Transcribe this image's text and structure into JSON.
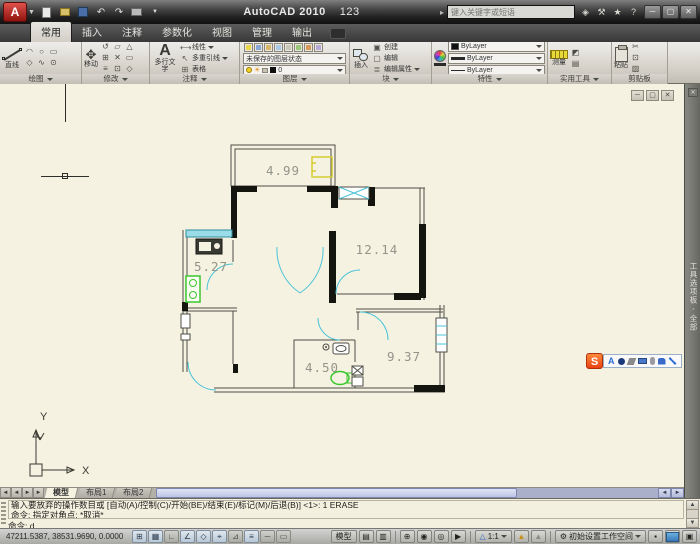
{
  "titlebar": {
    "app_title": "AutoCAD 2010",
    "doc_title": "123",
    "search_placeholder": "键入关键字或短语"
  },
  "ribbon": {
    "tabs": [
      {
        "label": "常用",
        "active": true
      },
      {
        "label": "插入",
        "active": false
      },
      {
        "label": "注释",
        "active": false
      },
      {
        "label": "参数化",
        "active": false
      },
      {
        "label": "视图",
        "active": false
      },
      {
        "label": "管理",
        "active": false
      },
      {
        "label": "输出",
        "active": false
      }
    ],
    "draw": {
      "title": "绘图",
      "line_label": "直线",
      "icons": [
        "◠",
        "○",
        "▭",
        "◇",
        "∿",
        "⊙"
      ]
    },
    "modify": {
      "title": "修改",
      "move_label": "移动",
      "icons": [
        "↺",
        "▱",
        "△",
        "⊞",
        "✕",
        "▭",
        "≡",
        "⊡",
        "◇"
      ]
    },
    "annotate": {
      "title": "注释",
      "mtext_label": "多行文字",
      "linear_label": "线性",
      "mleader_label": "多重引线",
      "table_label": "表格"
    },
    "layers": {
      "title": "图层",
      "layer_state": "未保存的图层状态",
      "layer_name": "0"
    },
    "block": {
      "title": "块",
      "insert_label": "插入",
      "create_label": "创建",
      "edit_label": "编辑",
      "edit_attr_label": "编辑属性"
    },
    "properties": {
      "title": "特性",
      "color_value": "ByLayer",
      "lineweight_value": "ByLayer",
      "linetype_value": "ByLayer"
    },
    "utilities": {
      "title": "实用工具",
      "measure_label": "测量"
    },
    "clipboard": {
      "title": "剪贴板",
      "paste_label": "粘贴"
    }
  },
  "canvas": {
    "rooms": [
      {
        "name": "balcony",
        "area_label": "4.99"
      },
      {
        "name": "bedroom-right",
        "area_label": "12.14"
      },
      {
        "name": "kitchen",
        "area_label": "5.27"
      },
      {
        "name": "bathroom",
        "area_label": "4.50"
      },
      {
        "name": "bedroom-bottom",
        "area_label": "9.37"
      }
    ],
    "ucs": {
      "x_label": "X",
      "y_label": "Y"
    },
    "palette_tab_label": "工具选项板 - 全部"
  },
  "ime_toolbar": {
    "logo": "S",
    "letter": "A"
  },
  "layout_tabs": [
    {
      "label": "模型",
      "active": true
    },
    {
      "label": "布局1",
      "active": false
    },
    {
      "label": "布局2",
      "active": false
    }
  ],
  "command_line": {
    "history_line1": "输入要放弃的操作数目或 [自动(A)/控制(C)/开始(BE)/结束(E)/标记(M)/后退(B)] <1>: 1 ERASE",
    "history_line2": "命令: 指定对角点: *取消*",
    "prompt": "命令: d"
  },
  "statusbar": {
    "coordinates": "47211.5387, 38531.9690, 0.0000",
    "toggles": [
      "⊞",
      "▦",
      "∟",
      "∠",
      "◇",
      "⌖",
      "⊿",
      "≡",
      "─",
      "▭"
    ],
    "model_label": "模型",
    "annotation_scale": "1:1",
    "workspace_label": "初始设置工作空间"
  },
  "icons": {
    "minimize": "─",
    "maximize": "▢",
    "close": "✕",
    "undo": "↶",
    "redo": "↷",
    "help": "?",
    "star": "★",
    "wrench": "⚒",
    "satellite": "◈",
    "search_arrow": "▸",
    "nav_first": "◄",
    "nav_prev": "◄",
    "nav_next": "►",
    "nav_last": "►",
    "quickview_layouts": "▤",
    "quickview_drawings": "▥",
    "pan": "⊕",
    "zoom": "◉",
    "steering_wheel": "◎",
    "show_motion": "▶",
    "ann_visibility": "▲",
    "ann_auto": "▲",
    "scale_person": "△",
    "workspace_gear": "⚙",
    "lock": "▪",
    "clean_screen": "▣",
    "table": "⊞",
    "linear_dim": "⟷",
    "mleader": "↖",
    "cut": "✂",
    "copy": "⊡",
    "matchprop": "▨",
    "create_block": "▣",
    "edit_block": "▢",
    "edit_attr": "≣",
    "measure_extra1": "◩",
    "measure_extra2": "▤"
  }
}
